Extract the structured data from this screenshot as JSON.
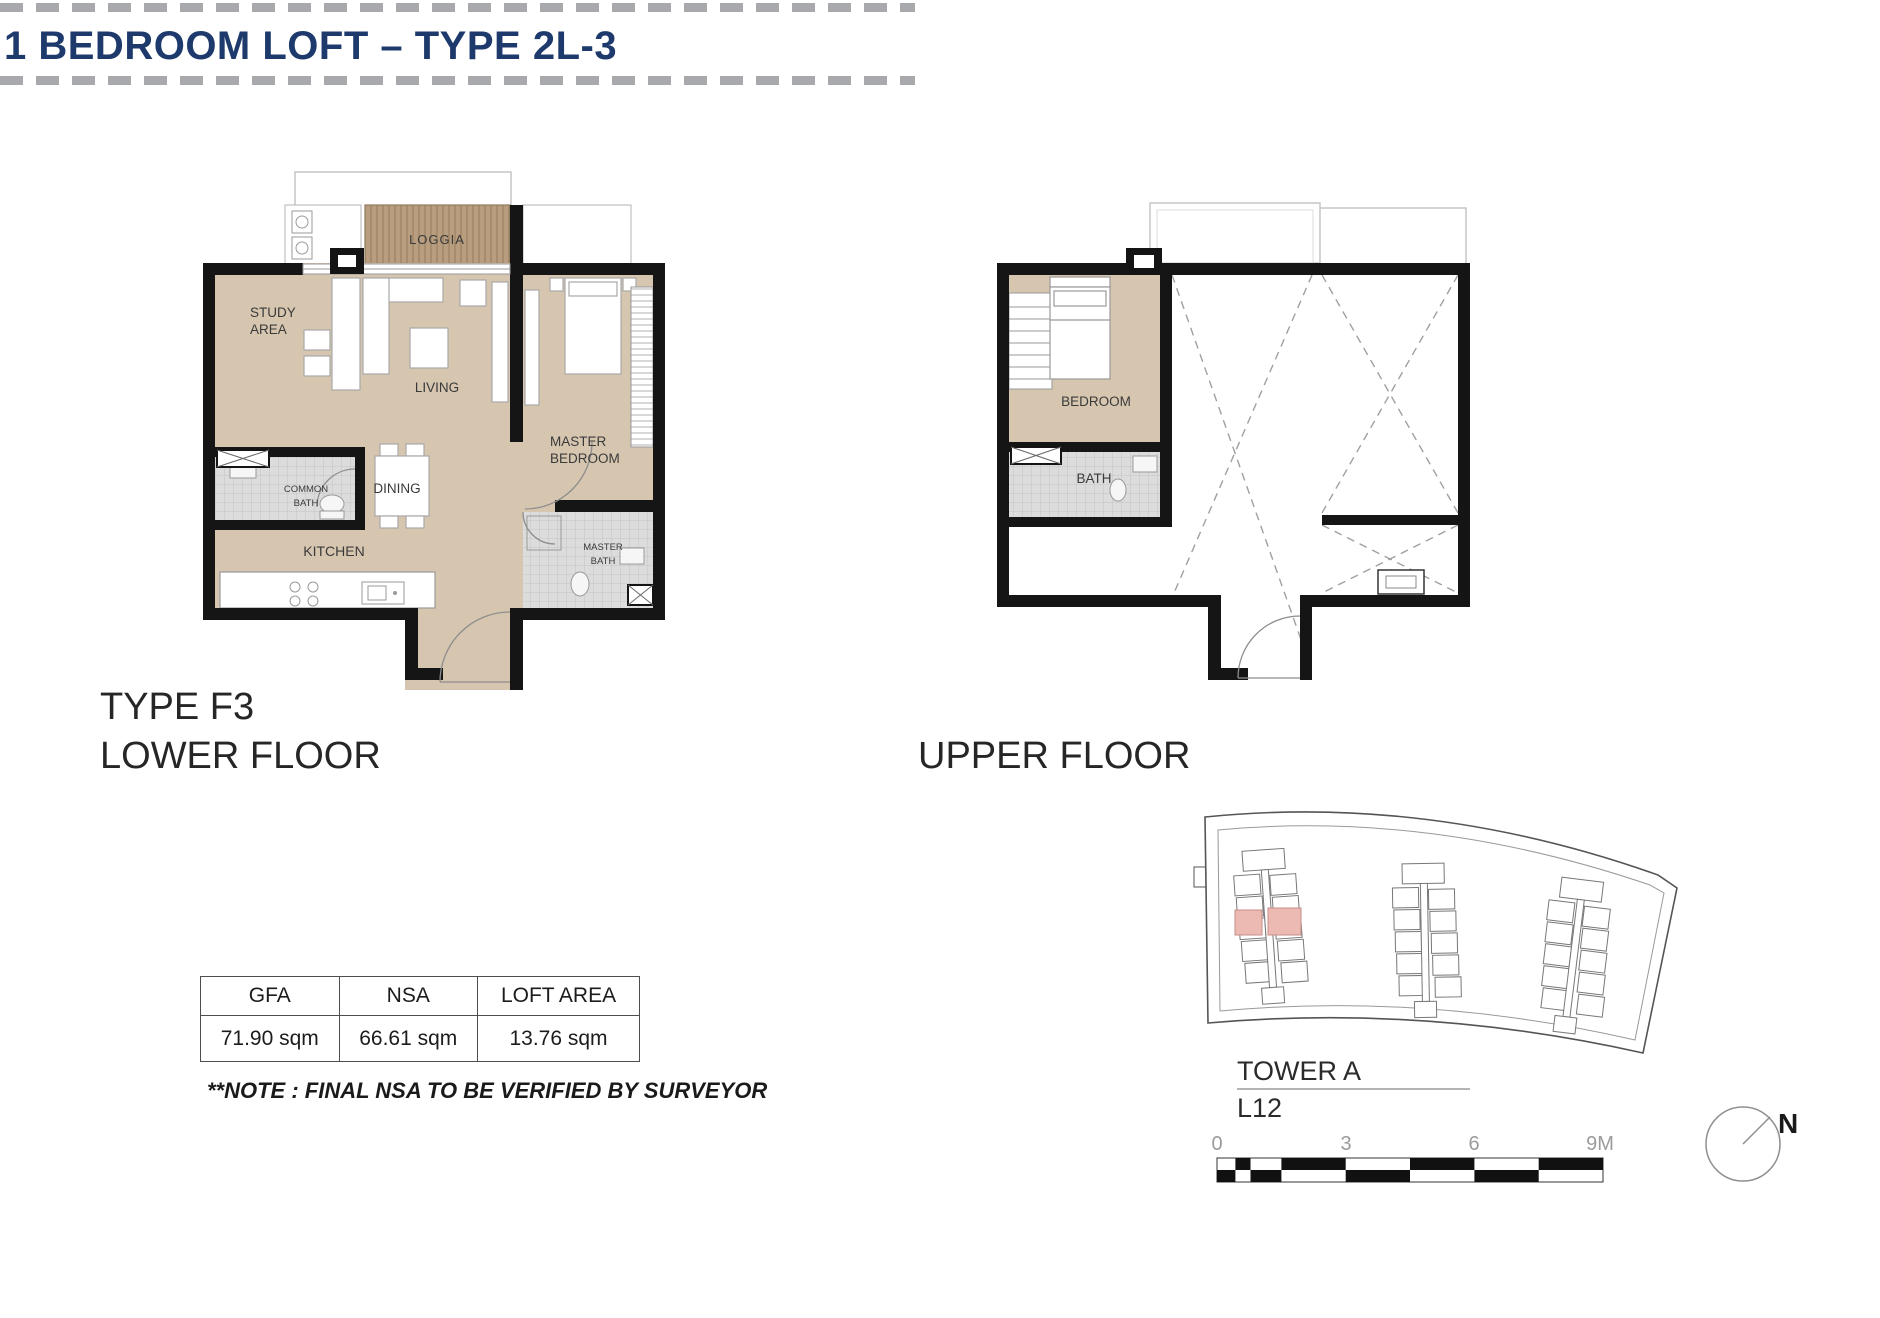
{
  "header": {
    "title": "1 BEDROOM LOFT – TYPE 2L-3"
  },
  "lower_floor": {
    "type_label": "TYPE F3",
    "floor_label": "LOWER FLOOR",
    "rooms": {
      "loggia": "LOGGIA",
      "study_line1": "STUDY",
      "study_line2": "AREA",
      "living": "LIVING",
      "master_bedroom_line1": "MASTER",
      "master_bedroom_line2": "BEDROOM",
      "common_bath_line1": "COMMON",
      "common_bath_line2": "BATH",
      "dining": "DINING",
      "kitchen": "KITCHEN",
      "master_bath_line1": "MASTER",
      "master_bath_line2": "BATH"
    }
  },
  "upper_floor": {
    "floor_label": "UPPER FLOOR",
    "rooms": {
      "bedroom": "BEDROOM",
      "bath": "BATH"
    }
  },
  "area_table": {
    "headers": [
      "GFA",
      "NSA",
      "LOFT AREA"
    ],
    "values": [
      "71.90 sqm",
      "66.61 sqm",
      "13.76 sqm"
    ]
  },
  "note": "**NOTE : FINAL NSA TO BE VERIFIED BY SURVEYOR",
  "site_plan": {
    "tower_label": "TOWER A",
    "level_label": "L12",
    "scale_ticks": [
      "0",
      "3",
      "6",
      "9M"
    ],
    "north_label": "N"
  },
  "colors": {
    "title_navy": "#1e3a6c",
    "floor_tan": "#d6c6b0",
    "loggia_brown": "#b89e7f",
    "unit_highlight_pink": "#ecb9b3"
  }
}
